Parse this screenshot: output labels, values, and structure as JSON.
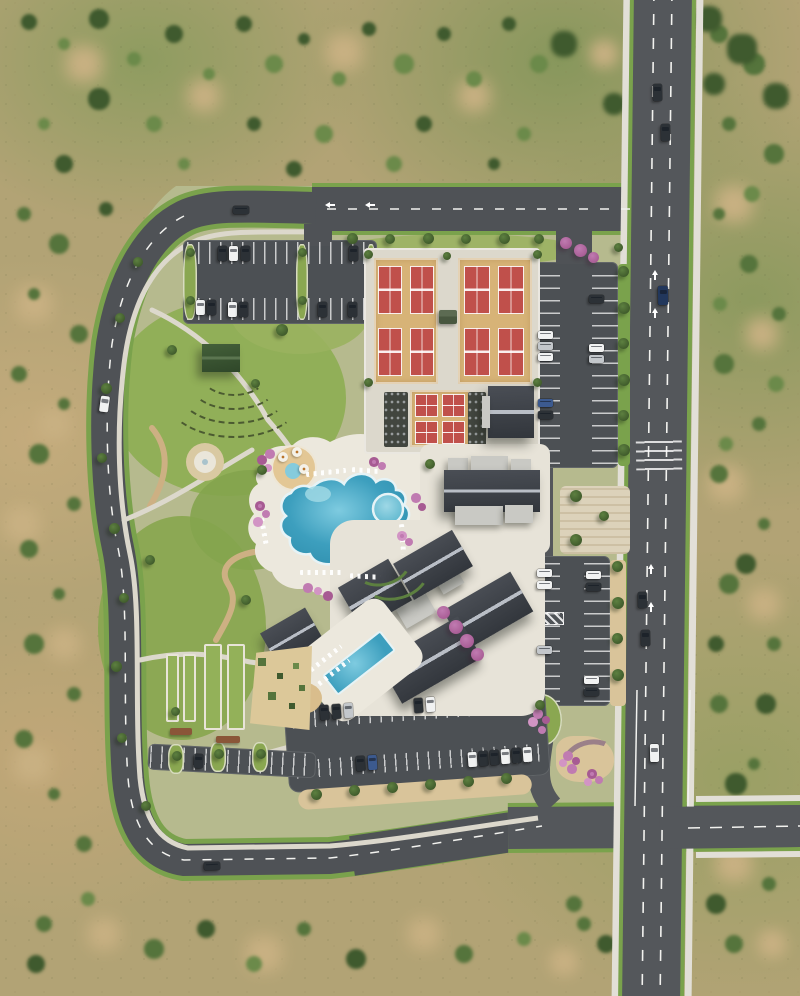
{
  "scene": {
    "type": "photorealistic aerial rendering, top-down",
    "subject": "master-planned community amenity center surrounded by desert scrub",
    "visible_text": "none"
  },
  "palette": {
    "desert_base": "#b2a375",
    "desert_light": "#c4ab7c",
    "desert_green": "#87975c",
    "scrub_patch": "#c9b183",
    "shrub_dark": "#3f5a2e",
    "shrub_mid": "#55743c",
    "shrub_light": "#6b8a4a",
    "site_ground": "#b6ba8e",
    "lawn": "#8aa751",
    "lawn_bright": "#93b159",
    "road": "#54575b",
    "road_dark": "#4c5054",
    "lane": "#f2f2ef",
    "verge": "#7aa24c",
    "sidewalk": "#e2dfd7",
    "path": "#dcd8cc",
    "trail": "#cdb083",
    "apron": "#d7b377",
    "court": "#c0504b",
    "court_line": "#ffffff",
    "canopy": "#42463f",
    "pool_deep": "#2f8fae",
    "pool_light": "#7ecbe0",
    "pool_edge": "#e6f3f6",
    "deck": "#ece8dd",
    "plaza": "#e7e3d8",
    "paseo": "#dcd2ba",
    "splash_tan": "#e3c795",
    "roof_dark": "#32363c",
    "roof_mid": "#4a4e55",
    "roof_ridge": "#b9bec6",
    "roof_light": "#c9c9c4",
    "roof_green": "#3e5a34",
    "tree": "#5d8040",
    "tree_dark": "#3f5a2b",
    "tree_pink": "#c07bb1",
    "flower_deep": "#a75b93",
    "hedge": "#5d8040",
    "seat": "#4b5a31",
    "sand": "#d9bd8c",
    "dg": "#d9c49a",
    "planter": "#8a5638",
    "car_white": "#f1f2f2",
    "car_silver": "#c3c7cb",
    "car_dark": "#2c3136",
    "car_blue": "#3c5a8f",
    "car_navy": "#22375c"
  },
  "features": {
    "desert_scrub": "undeveloped desert with scattered green shrubs surrounds the parcel",
    "main_road": "north-south arterial on the right with dashed lane lines, turn arrows, green verges and sidewalks",
    "cross_street": "four-way intersection in the lower right",
    "loop_road": "curving perimeter street wrapping the west and south of the site",
    "entry_drive": "landscaped drive from the intersection through the south parking",
    "tennis_complex": "two tan pads each holding four red courts",
    "south_court_pad": "smaller tan pad with four red courts flanked by dark shade canopies",
    "courts_building": "gray gabled-roof building east of the small court pad",
    "clubhouse": "large dark gabled roof with light flat-roof wings east of the resort pool",
    "amenity_buildings": "five dark gabled roofs set diagonally around a courtyard of pink flowering trees",
    "resort_pool": "free-form blue pool with tanning shelf, round spa and white deck with loungers",
    "splash_pad": "round tan splash court with umbrellas northwest of the pool",
    "lap_pool": "diagonal rectangular blue lap pool with lounger rows and sand patch",
    "event_lawn": "large lawn with concentric amphitheater seating rows",
    "stage_pavilion": "green-roofed stage pavilion at the head of the lawn",
    "fountain_plaza": "small circular plaza west of the pool deck",
    "bocce_courts": "narrow green lanes framed in white with planter boxes",
    "dog_park": "tan gravel yard with shrubs southwest of the lap pool",
    "north_parking": "double-bay lot below the top road",
    "east_parking": "two tree-lined bays between the site and the main road",
    "south_parking": "angled rows along the entry drive plus street parking on the loop",
    "paseo": "decorative paved pedestrian band from the clubhouse to the main road",
    "entry_arbor": "curved arbor and flower garden at the southeast entry corner",
    "vehicles": "parked and moving cars in white, silver, dark gray and blue"
  },
  "counts": {
    "tennis_courts": 8,
    "small_courts": 4,
    "bocce_lanes": 4
  }
}
